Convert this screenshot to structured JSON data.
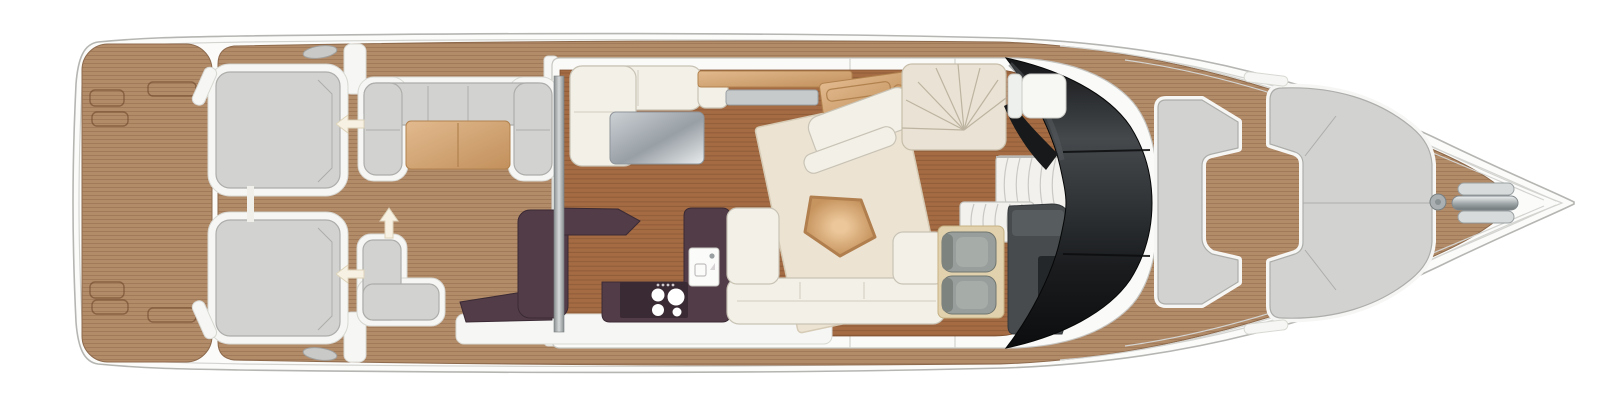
{
  "meta": {
    "title": "Motor yacht main deck floor plan, top-down view, bow pointing right",
    "canvas": {
      "width": 1600,
      "height": 406
    }
  },
  "palette": {
    "background": "#ffffff",
    "hull_white": "#fbfbfa",
    "hull_outline": "#b5b5b2",
    "hull_inner_line": "#d3d3d0",
    "teak_base": "#b28b69",
    "teak_line": "#8f6a4c",
    "floor_base": "#a56c44",
    "floor_line": "#7c4e2d",
    "deckhouse_white": "#fafaf8",
    "pad_gray": "#d2d3d1",
    "pad_outline": "#adadaa",
    "white_trim": "#f6f6f4",
    "sofa_cream": "#f3f0e7",
    "sofa_outline": "#c8c3b5",
    "rug_cream": "#ece3d3",
    "rug_outline": "#d6cbb5",
    "table_tan": "#d9ae81",
    "aubergine": "#523c47",
    "aubergine_dark": "#3a2a34",
    "console_gray": "#474b4e",
    "console_dark": "#24272a",
    "windshield_black": "#0c0d0e",
    "seat_gray": "#989e9b",
    "stair_cream": "#eae2d4",
    "stair_line": "#bdb3a0",
    "arrow_cream": "#f6f1e2"
  },
  "arrows": [
    {
      "id": "stern-walkthrough-port",
      "direction": "left"
    },
    {
      "id": "stern-walkthrough-starboard",
      "direction": "left"
    },
    {
      "id": "cockpit-side-access",
      "direction": "up"
    }
  ],
  "features": [
    {
      "name": "swim-platform"
    },
    {
      "name": "stern-sunpad-port"
    },
    {
      "name": "stern-sunpad-starboard"
    },
    {
      "name": "cockpit-sofa"
    },
    {
      "name": "cockpit-table"
    },
    {
      "name": "cockpit-corner-seat"
    },
    {
      "name": "galley-island"
    },
    {
      "name": "galley-counter"
    },
    {
      "name": "cooktop"
    },
    {
      "name": "sink"
    },
    {
      "name": "dinette-sofa"
    },
    {
      "name": "dinette-table"
    },
    {
      "name": "sideboard"
    },
    {
      "name": "desk"
    },
    {
      "name": "chaise"
    },
    {
      "name": "saloon-rug"
    },
    {
      "name": "coffee-table"
    },
    {
      "name": "saloon-sofa"
    },
    {
      "name": "stairs-up-flybridge"
    },
    {
      "name": "stairs-down-lower-deck"
    },
    {
      "name": "helm-seats"
    },
    {
      "name": "helm-console"
    },
    {
      "name": "windshield"
    },
    {
      "name": "navigator-seat"
    },
    {
      "name": "foredeck-sunpad"
    },
    {
      "name": "bow-seating"
    },
    {
      "name": "anchor-windlass"
    }
  ]
}
